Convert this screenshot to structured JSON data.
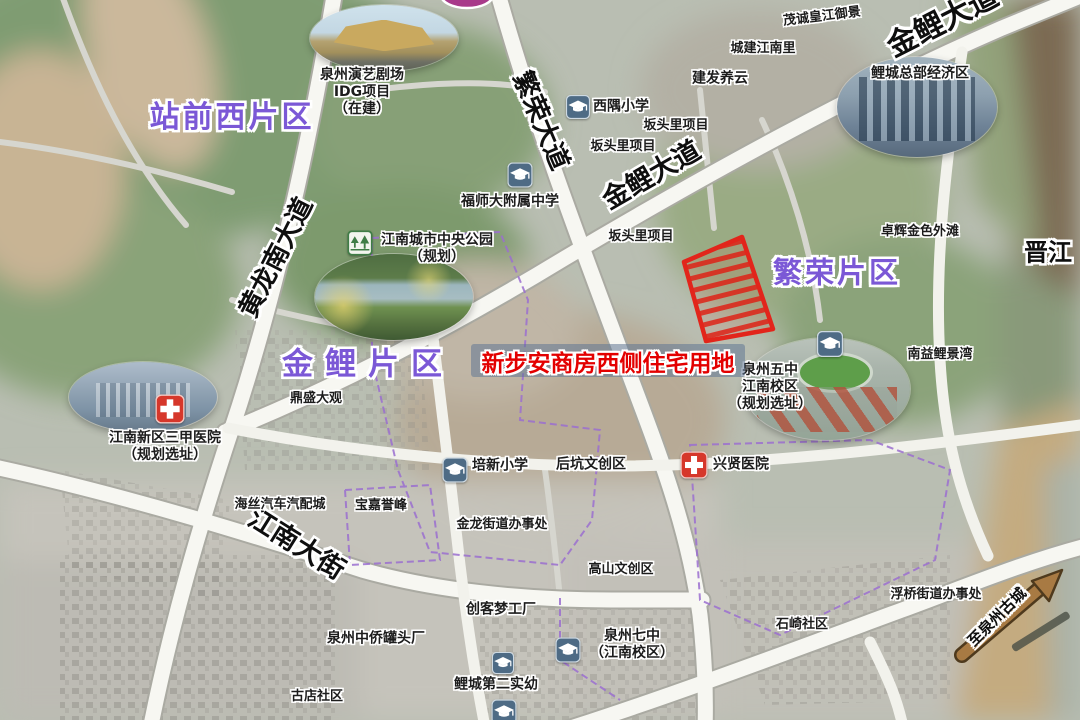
{
  "map": {
    "colors": {
      "district_purple": "#7b58d6",
      "highlight_red": "#e30000",
      "highlight_band": "rgba(96,118,148,0.55)",
      "road_white": "#f7f7f2",
      "hospital_red": "#d6372b",
      "school_blue": "#4e6b85",
      "park_green": "#3f7d46",
      "arrow_brown": "#a87a43"
    },
    "highlight": {
      "label": "新步安商房西侧住宅用地"
    },
    "district_labels": [
      {
        "name": "district-label-zhanqianxi",
        "text": "站前西片区",
        "x": 232,
        "y": 118,
        "size": 30,
        "ls": 3
      },
      {
        "name": "district-label-jinli",
        "text": "金鲤片区",
        "x": 368,
        "y": 365,
        "size": 31,
        "ls": 12
      },
      {
        "name": "district-label-fanrong",
        "text": "繁荣片区",
        "x": 837,
        "y": 273,
        "size": 29,
        "ls": 3
      }
    ],
    "road_labels": [
      {
        "name": "road-label-fanrong-dadao",
        "text": "繁荣大道",
        "x": 540,
        "y": 121,
        "size": 26,
        "rotate": 67
      },
      {
        "name": "road-label-jinli-dadao",
        "text": "金鲤大道",
        "x": 652,
        "y": 176,
        "size": 27,
        "rotate": -30
      },
      {
        "name": "road-label-jinli-dadao-ne",
        "text": "金鲤大道",
        "x": 943,
        "y": 22,
        "size": 30,
        "rotate": -27
      },
      {
        "name": "road-label-huanglongnan",
        "text": "黄龙南大道",
        "x": 277,
        "y": 258,
        "size": 26,
        "rotate": -63
      },
      {
        "name": "road-label-jiangnan-dajie",
        "text": "江南大街",
        "x": 296,
        "y": 545,
        "size": 27,
        "rotate": 32
      },
      {
        "name": "road-label-to-old-town",
        "text": "至泉州古城",
        "x": 997,
        "y": 617,
        "size": 15,
        "rotate": -45
      }
    ],
    "place_labels": [
      {
        "name": "label-theater",
        "lines": [
          "泉州演艺剧场",
          "IDG项目",
          "（在建）"
        ],
        "x": 362,
        "y": 92,
        "size": 14
      },
      {
        "name": "label-maocheng",
        "lines": [
          "茂诚皇江御景"
        ],
        "x": 822,
        "y": 17,
        "size": 13,
        "rotate": -7
      },
      {
        "name": "label-chengjian",
        "lines": [
          "城建江南里"
        ],
        "x": 763,
        "y": 49,
        "size": 13
      },
      {
        "name": "label-jianfa",
        "lines": [
          "建发养云"
        ],
        "x": 720,
        "y": 79,
        "size": 14
      },
      {
        "name": "label-xiyu-primary",
        "lines": [
          "西隅小学"
        ],
        "x": 621,
        "y": 107,
        "size": 14
      },
      {
        "name": "label-bantouli-1",
        "lines": [
          "坂头里项目"
        ],
        "x": 676,
        "y": 126,
        "size": 13
      },
      {
        "name": "label-bantouli-2",
        "lines": [
          "坂头里项目"
        ],
        "x": 623,
        "y": 147,
        "size": 13
      },
      {
        "name": "label-licheng-hq",
        "lines": [
          "鲤城总部经济区"
        ],
        "x": 920,
        "y": 74,
        "size": 14
      },
      {
        "name": "label-fushida",
        "lines": [
          "福师大附属中学"
        ],
        "x": 510,
        "y": 202,
        "size": 14
      },
      {
        "name": "label-central-park",
        "lines": [
          "江南城市中央公园",
          "（规划）"
        ],
        "x": 437,
        "y": 249,
        "size": 14
      },
      {
        "name": "label-zhuohui",
        "lines": [
          "卓辉金色外滩"
        ],
        "x": 920,
        "y": 232,
        "size": 13
      },
      {
        "name": "label-jinjiang-river",
        "lines": [
          "晋江"
        ],
        "x": 1048,
        "y": 253,
        "size": 24,
        "big": true
      },
      {
        "name": "label-bantouli-3",
        "lines": [
          "坂头里项目"
        ],
        "x": 641,
        "y": 237,
        "size": 13
      },
      {
        "name": "label-nanyi",
        "lines": [
          "南益鲤景湾"
        ],
        "x": 940,
        "y": 355,
        "size": 13
      },
      {
        "name": "label-wuzhong",
        "lines": [
          "泉州五中",
          "江南校区",
          "（规划选址）"
        ],
        "x": 770,
        "y": 387,
        "size": 14
      },
      {
        "name": "label-dingsheng",
        "lines": [
          "鼎盛大观"
        ],
        "x": 316,
        "y": 399,
        "size": 13
      },
      {
        "name": "label-hospital-3a",
        "lines": [
          "江南新区三甲医院",
          "（规划选址）"
        ],
        "x": 165,
        "y": 447,
        "size": 14
      },
      {
        "name": "label-haisi-auto",
        "lines": [
          "海丝汽车汽配城"
        ],
        "x": 280,
        "y": 505,
        "size": 13
      },
      {
        "name": "label-baojia",
        "lines": [
          "宝嘉誉峰"
        ],
        "x": 381,
        "y": 506,
        "size": 13
      },
      {
        "name": "label-peixin-primary",
        "lines": [
          "培新小学"
        ],
        "x": 500,
        "y": 466,
        "size": 14
      },
      {
        "name": "label-houkeng",
        "lines": [
          "后坑文创区"
        ],
        "x": 591,
        "y": 465,
        "size": 14
      },
      {
        "name": "label-xingxian-hospital",
        "lines": [
          "兴贤医院"
        ],
        "x": 741,
        "y": 465,
        "size": 14
      },
      {
        "name": "label-jinlong-office",
        "lines": [
          "金龙街道办事处"
        ],
        "x": 502,
        "y": 525,
        "size": 13
      },
      {
        "name": "label-gaoshan",
        "lines": [
          "高山文创区"
        ],
        "x": 621,
        "y": 570,
        "size": 13
      },
      {
        "name": "label-chuangke",
        "lines": [
          "创客梦工厂"
        ],
        "x": 501,
        "y": 610,
        "size": 14
      },
      {
        "name": "label-zhongqiao",
        "lines": [
          "泉州中侨罐头厂"
        ],
        "x": 376,
        "y": 639,
        "size": 14
      },
      {
        "name": "label-qizhong",
        "lines": [
          "泉州七中",
          "（江南校区）"
        ],
        "x": 632,
        "y": 645,
        "size": 14
      },
      {
        "name": "label-licheng-kinder",
        "lines": [
          "鲤城第二实幼"
        ],
        "x": 496,
        "y": 685,
        "size": 14
      },
      {
        "name": "label-shiqi",
        "lines": [
          "石崎社区"
        ],
        "x": 802,
        "y": 625,
        "size": 13
      },
      {
        "name": "label-fuqiao-office",
        "lines": [
          "浮桥街道办事处"
        ],
        "x": 936,
        "y": 595,
        "size": 13
      },
      {
        "name": "label-gudian",
        "lines": [
          "古店社区"
        ],
        "x": 317,
        "y": 697,
        "size": 13
      }
    ],
    "markers": [
      {
        "name": "school-icon-xiyu",
        "type": "school",
        "x": 578,
        "y": 107,
        "size": 24
      },
      {
        "name": "school-icon-fushida",
        "type": "school",
        "x": 520,
        "y": 175,
        "size": 25
      },
      {
        "name": "school-icon-wuzhong",
        "type": "school",
        "x": 830,
        "y": 344,
        "size": 26
      },
      {
        "name": "school-icon-peixin",
        "type": "school",
        "x": 455,
        "y": 470,
        "size": 25
      },
      {
        "name": "school-icon-qizhong",
        "type": "school",
        "x": 568,
        "y": 650,
        "size": 25
      },
      {
        "name": "school-icon-kinder-1",
        "type": "school",
        "x": 503,
        "y": 663,
        "size": 22
      },
      {
        "name": "school-icon-kinder-2",
        "type": "school",
        "x": 504,
        "y": 712,
        "size": 25
      },
      {
        "name": "hospital-icon-3a",
        "type": "hospital",
        "x": 170,
        "y": 409,
        "size": 29
      },
      {
        "name": "hospital-icon-xingxian",
        "type": "hospital",
        "x": 694,
        "y": 465,
        "size": 27
      },
      {
        "name": "park-icon-central",
        "type": "park",
        "x": 360,
        "y": 243,
        "size": 25
      }
    ],
    "photos": [
      {
        "name": "photo-theater",
        "kind": "theater",
        "cx": 384,
        "cy": 38,
        "rx": 74,
        "ry": 33
      },
      {
        "name": "photo-central-park",
        "kind": "park",
        "cx": 394,
        "cy": 297,
        "rx": 79,
        "ry": 43
      },
      {
        "name": "photo-licheng-hq",
        "kind": "towers",
        "cx": 917,
        "cy": 107,
        "rx": 80,
        "ry": 50
      },
      {
        "name": "photo-wuzhong-campus",
        "kind": "school-campus",
        "cx": 827,
        "cy": 389,
        "rx": 83,
        "ry": 51
      },
      {
        "name": "photo-hospital-3a",
        "kind": "hospital-building",
        "cx": 143,
        "cy": 397,
        "rx": 74,
        "ry": 35
      }
    ]
  }
}
